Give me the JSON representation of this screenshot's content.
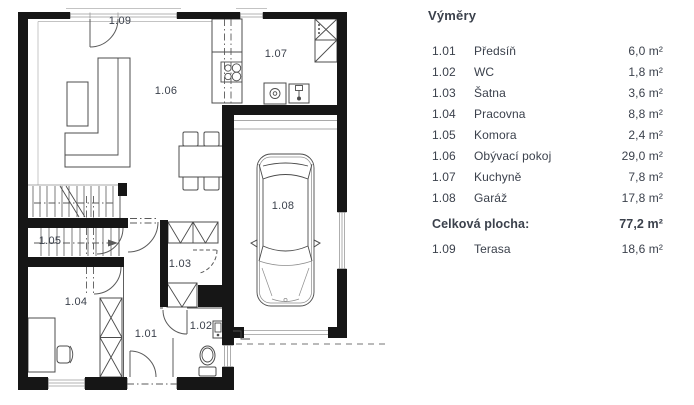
{
  "plan": {
    "labels": [
      "1.01",
      "1.02",
      "1.03",
      "1.04",
      "1.05",
      "1.06",
      "1.07",
      "1.08",
      "1.09"
    ]
  },
  "legend": {
    "title": "Výměry",
    "rows": [
      {
        "num": "1.01",
        "name": "Předsíň",
        "area": "6,0 m²"
      },
      {
        "num": "1.02",
        "name": "WC",
        "area": "1,8 m²"
      },
      {
        "num": "1.03",
        "name": "Šatna",
        "area": "3,6 m²"
      },
      {
        "num": "1.04",
        "name": "Pracovna",
        "area": "8,8 m²"
      },
      {
        "num": "1.05",
        "name": "Komora",
        "area": "2,4 m²"
      },
      {
        "num": "1.06",
        "name": "Obývací pokoj",
        "area": "29,0 m²"
      },
      {
        "num": "1.07",
        "name": "Kuchyně",
        "area": "7,8 m²"
      },
      {
        "num": "1.08",
        "name": "Garáž",
        "area": "17,8 m²"
      }
    ],
    "total": {
      "label": "Celková plocha:",
      "area": "77,2 m²"
    },
    "terrace": {
      "num": "1.09",
      "name": "Terasa",
      "area": "18,6 m²"
    }
  }
}
